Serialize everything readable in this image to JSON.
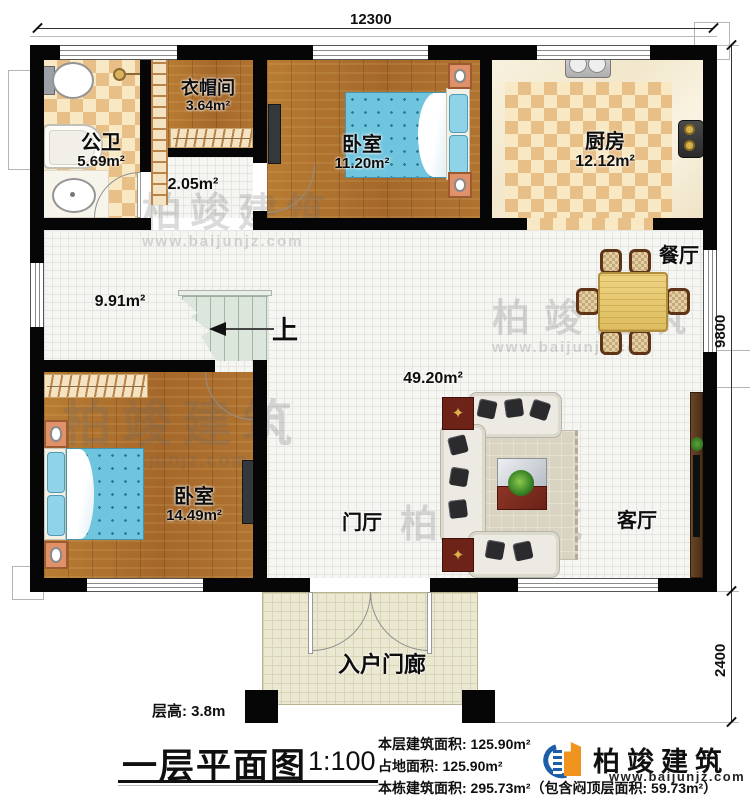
{
  "dimensions": {
    "top": "12300",
    "right_upper": "9800",
    "right_lower": "2400"
  },
  "rooms": {
    "bathroom": {
      "name": "公卫",
      "area": "5.69m²"
    },
    "cloakroom": {
      "name": "衣帽间",
      "area": "3.64m²"
    },
    "hallway": {
      "area": "2.05m²"
    },
    "bedroom_top": {
      "name": "卧室",
      "area": "11.20m²"
    },
    "kitchen": {
      "name": "厨房",
      "area": "12.12m²"
    },
    "corridor": {
      "area": "9.91m²"
    },
    "dining": {
      "name": "餐厅"
    },
    "open_area": {
      "area": "49.20m²"
    },
    "foyer": {
      "name": "门厅"
    },
    "living": {
      "name": "客厅"
    },
    "bedroom_bottom": {
      "name": "卧室",
      "area": "14.49m²"
    },
    "porch": {
      "name": "入户门廊"
    },
    "stair_up": "上"
  },
  "annotations": {
    "floor_height": "层高: 3.8m",
    "title": "一层平面图",
    "scale": "1:100",
    "stats": [
      "本层建筑面积: 125.90m²",
      "占地面积: 125.90m²",
      "本栋建筑面积: 295.73m²（包含闷顶层面积: 59.73m²）"
    ]
  },
  "logo": {
    "name": "柏竣建筑",
    "url": "www.baijunjz.com"
  },
  "watermark": {
    "name": "柏竣建筑",
    "url": "www.baijunjz.com"
  },
  "colors": {
    "wall": "#060606",
    "wood": "#ae7029",
    "checker_dark": "#e8bf87",
    "checker_light": "#f8e9c4",
    "tile": "#f5f5f2",
    "porch_tile": "#ebe8d1",
    "stairs": "#dde6dd",
    "mattress": "#70c5de",
    "logo_blue": "#1c5fa8",
    "logo_orange": "#f0931f"
  }
}
